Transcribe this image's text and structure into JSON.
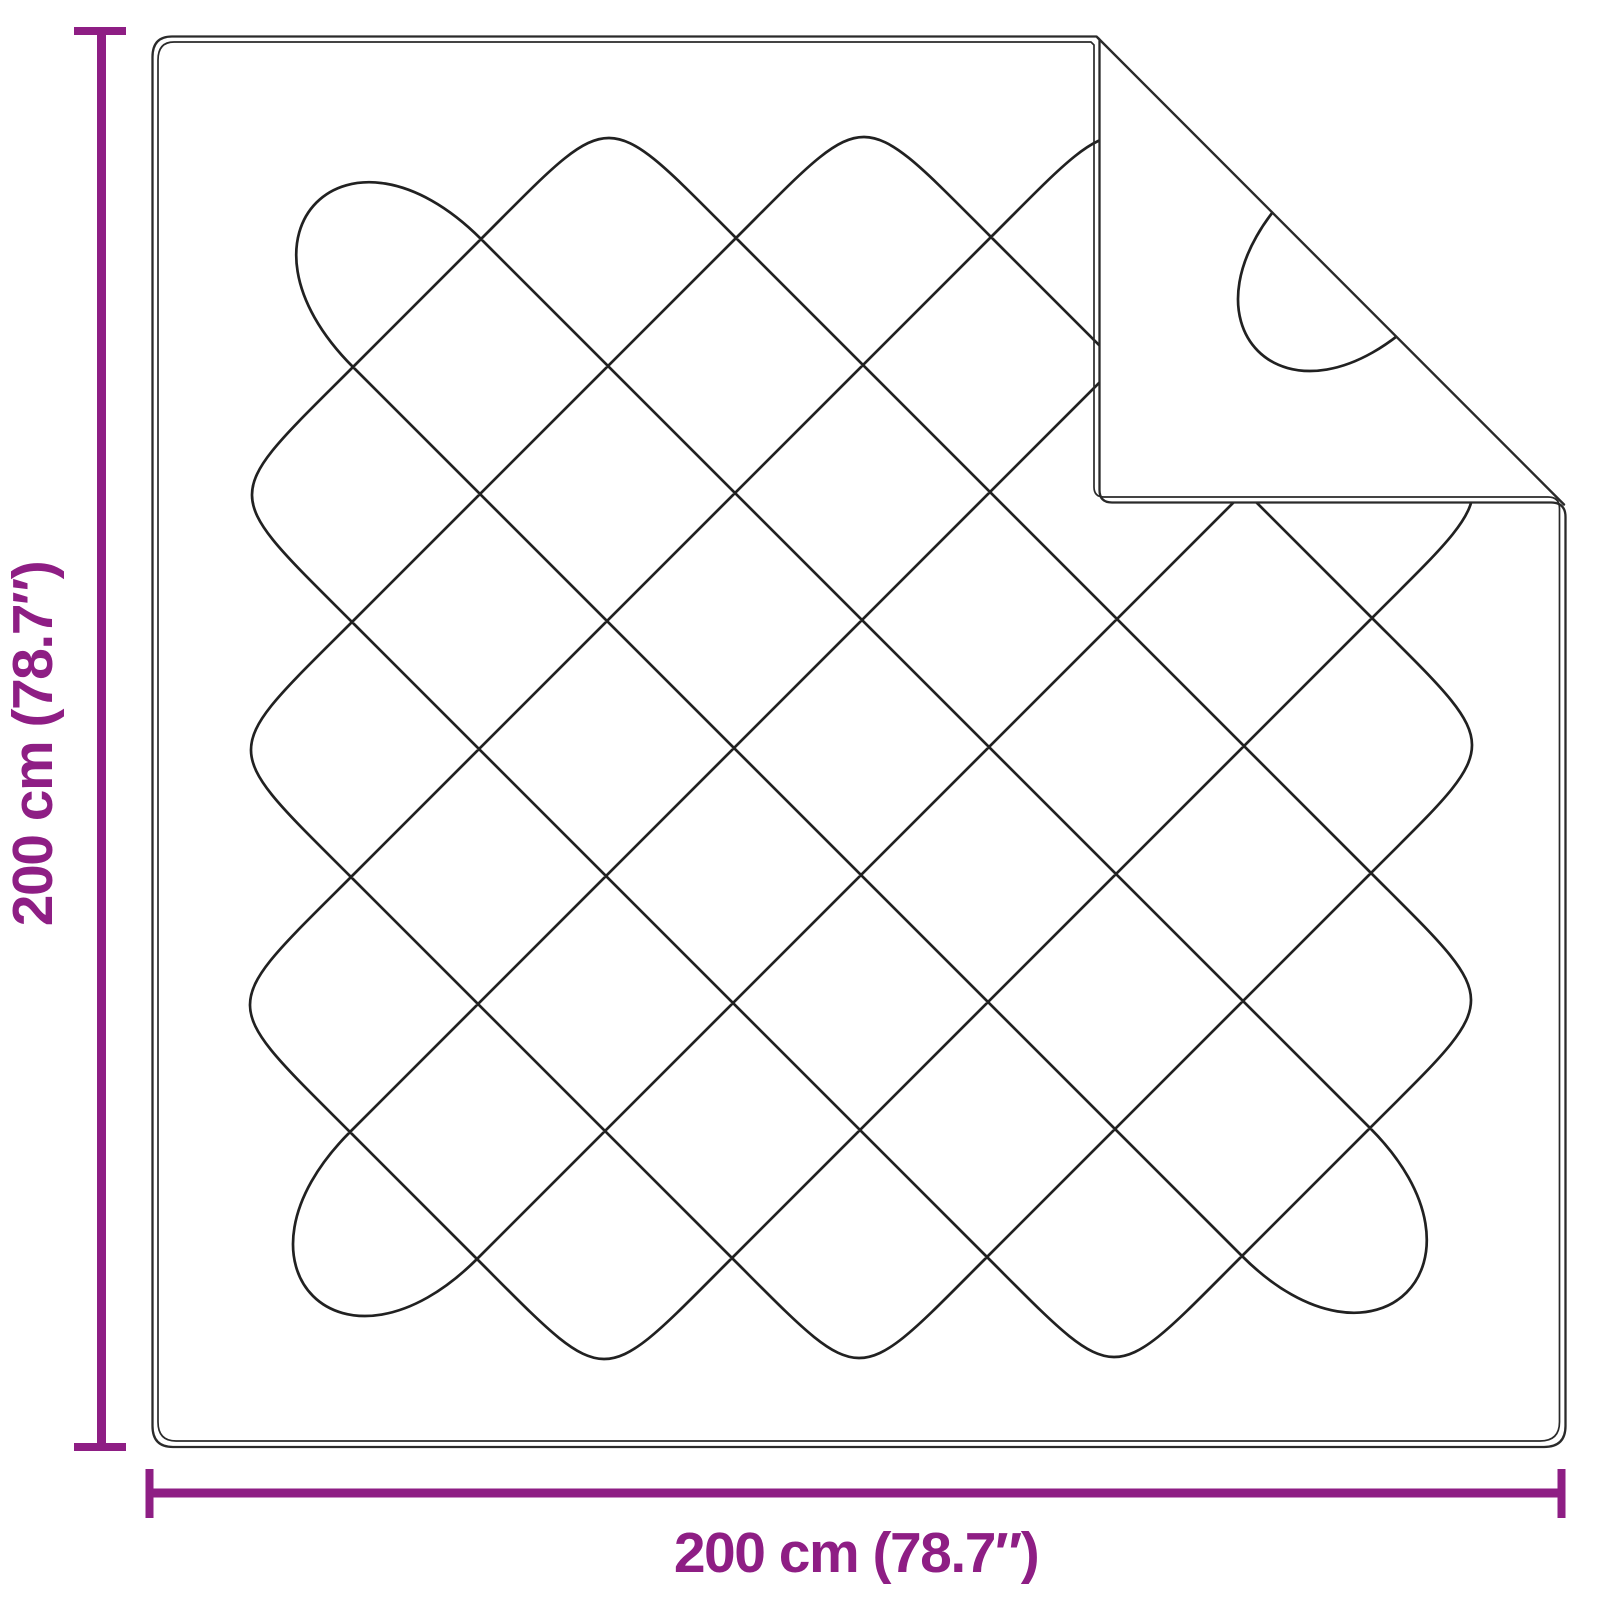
{
  "diagram": {
    "name": "blanket-dimension-diagram",
    "width_label": "200 cm (78.7″)",
    "height_label": "200 cm (78.7″)",
    "width_cm": "200",
    "height_cm": "200",
    "width_inches": "78.7",
    "height_inches": "78.7",
    "colors": {
      "dimension": "#8E1E84",
      "outline": "#2A2A2A",
      "stitch": "#212121",
      "background": "#FFFFFF"
    }
  }
}
